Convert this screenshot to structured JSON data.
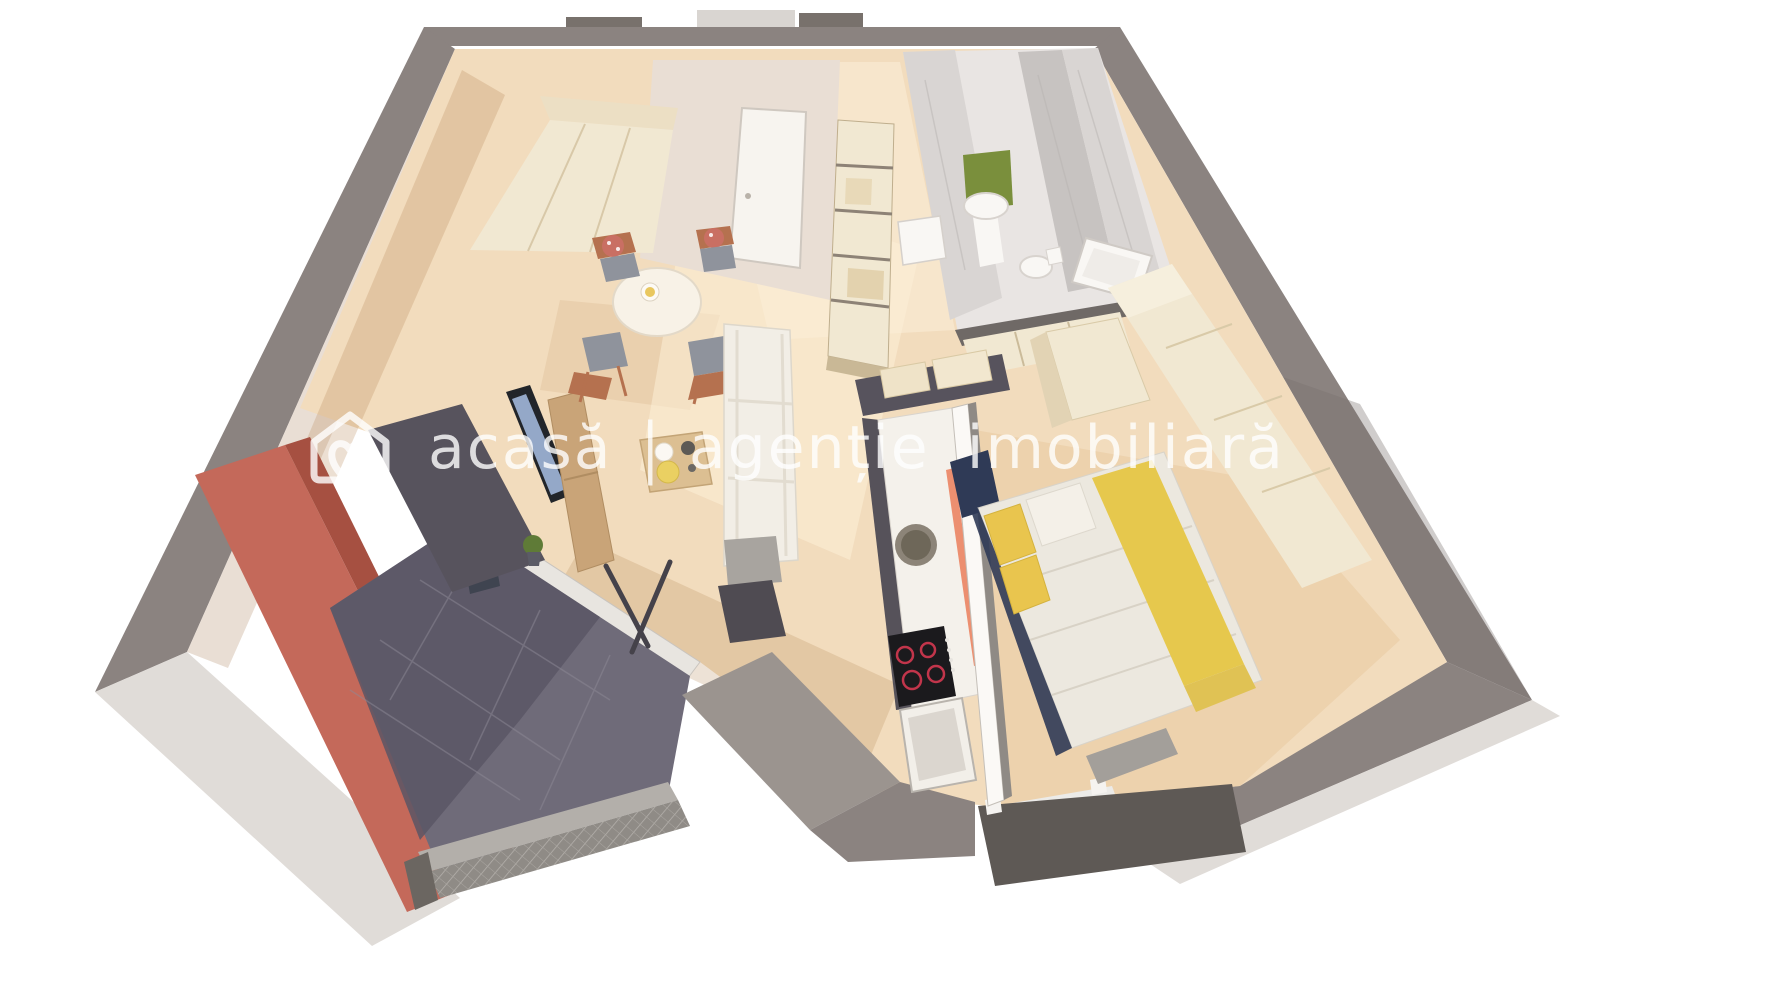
{
  "meta": {
    "type": "3d-floorplan-render",
    "view": "dollhouse-top-perspective"
  },
  "watermark": {
    "logo_icon": "house-heart-logo",
    "brand": "acasă",
    "separator": "|",
    "tagline": "agenție imobiliară",
    "color": "#ffffff",
    "opacity": "0.8"
  },
  "scene": {
    "rooms": [
      "living-room",
      "dining-area",
      "hallway",
      "bathroom",
      "kitchen",
      "bedroom",
      "balcony"
    ],
    "palette": {
      "bg": "#ffffff",
      "wallOuter": "#8b8380",
      "wallOuterDark": "#78716c",
      "wallOuterLight": "#9b948f",
      "wallBottomFace": "#e0dcd8",
      "wallInner": "#e9ded4",
      "wallInnerLight": "#f0e6dd",
      "floorWood": "#f2dcbd",
      "floorShadow": "#b98c5c",
      "floorSun": "#fdf2da",
      "bathFloor": "#e9e5e3",
      "balconyRed": "#c4695a",
      "balconyRedDark": "#a65041",
      "balconyFloor": "#6f6b79",
      "balconyFloorDark": "#5a5665",
      "railing": "#8f8b86",
      "railingLight": "#b3afaa",
      "accentWall": "#57535d",
      "tvBlack": "#22252a",
      "tvScreen": "#94a8c8",
      "woodFurniture": "#c9a478",
      "coffeeWood": "#dcbf92",
      "chairWood": "#b5714f",
      "seatGray": "#8f939c",
      "cushionFloral": "#c96f63",
      "sofaWhite": "#f2eee6",
      "tableWhite": "#f8f2e7",
      "creamCab": "#f1e8d2",
      "creamCabSide": "#e2d3b4",
      "marbleWall": "#d9d5d3",
      "marbleDark": "#c7c3c1",
      "fixtureWhite": "#f9f7f4",
      "counterTop": "#f4f1eb",
      "counterAccent": "#ec8f70",
      "cooktop": "#1b1a1d",
      "burner": "#c2354b",
      "sinkOuter": "#8c8478",
      "sinkInner": "#6e6759",
      "duvet": "#ece8df",
      "runnerYellow": "#e6c84d",
      "pillowYellow": "#e9c54e",
      "bedNavy": "#2f3a56",
      "benchGray": "#a39f9a",
      "stepDark": "#5e5955",
      "windowSill": "#ecebe8",
      "doorWhite": "#f7f4ef",
      "plantGreen": "#5f7b37",
      "artGreen": "#7a8f3c",
      "dividerWhite": "#fbf9f6",
      "dividerGray": "#8f8a85",
      "watermarkColor": "#ffffff"
    }
  }
}
